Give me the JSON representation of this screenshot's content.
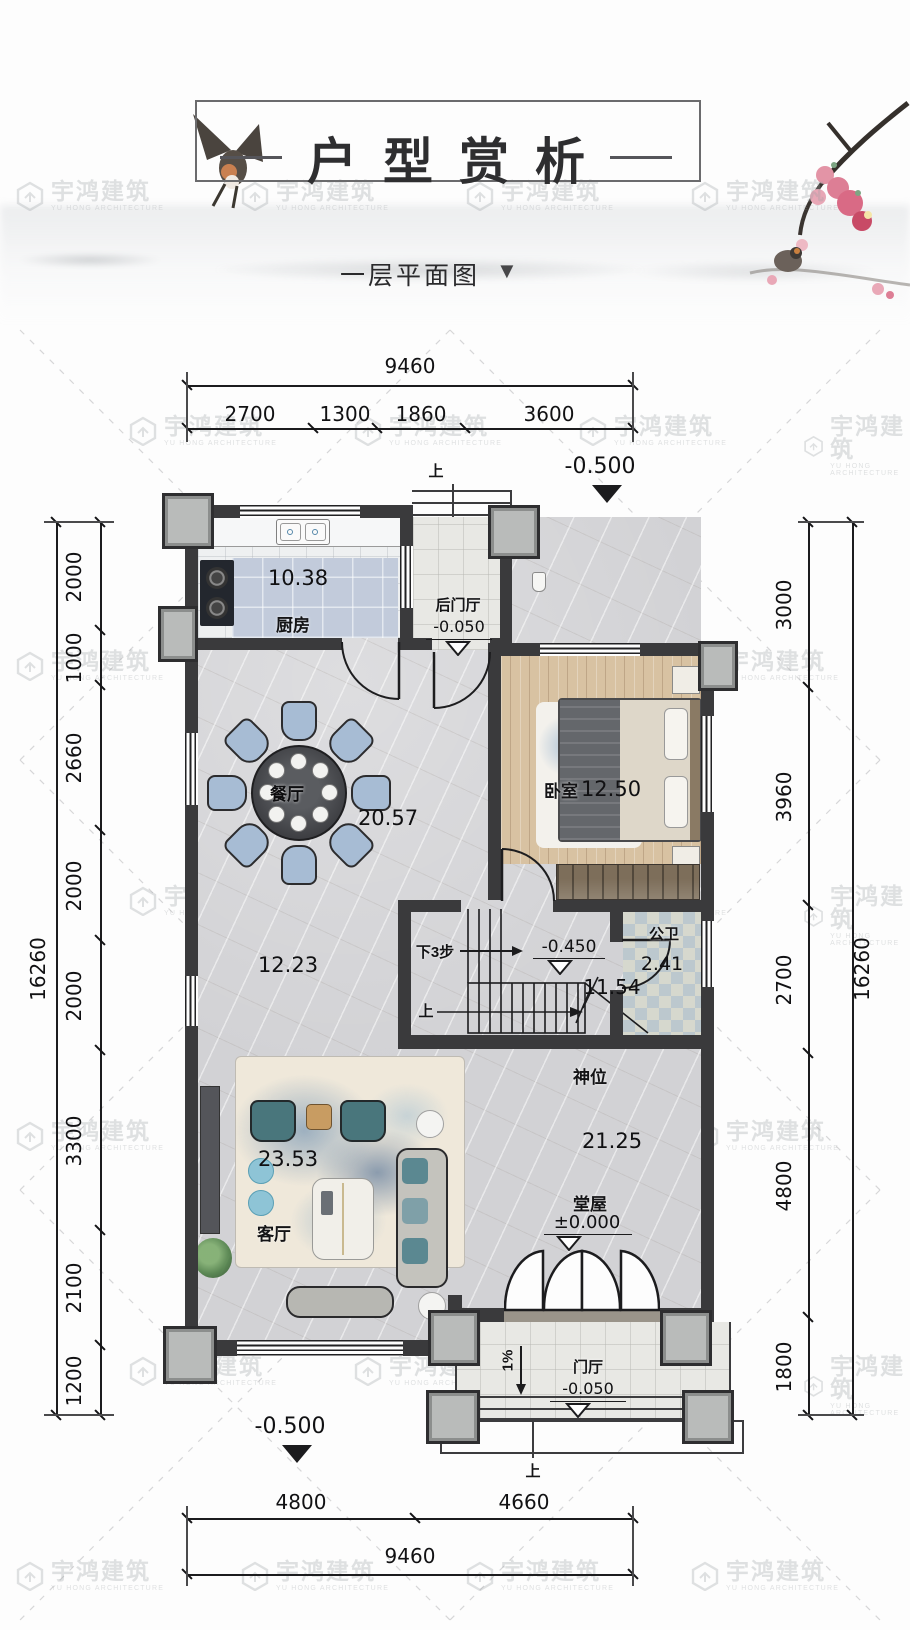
{
  "header": {
    "title": "户型赏析",
    "subtitle": "一层平面图",
    "subtitle_marker": "▼"
  },
  "watermark": {
    "cn": "宇鸿建筑",
    "en": "YU HONG ARCHITECTURE"
  },
  "site": {
    "north_level": "-0.500",
    "south_level": "-0.500"
  },
  "dims": {
    "top": {
      "total": "9460",
      "segments": [
        "2700",
        "1300",
        "1860",
        "3600"
      ]
    },
    "bottom": {
      "total": "9460",
      "segments": [
        "4800",
        "4660"
      ]
    },
    "left": {
      "total": "16260",
      "segments": [
        "2000",
        "1000",
        "2660",
        "2000",
        "2000",
        "3300",
        "2100",
        "1200"
      ]
    },
    "right": {
      "total": "16260",
      "segments": [
        "3000",
        "3960",
        "2700",
        "4800",
        "1800"
      ]
    }
  },
  "rooms": {
    "kitchen": {
      "name": "厨房",
      "area": "10.38"
    },
    "back_foyer": {
      "name": "后门厅",
      "level": "-0.050"
    },
    "dining": {
      "name": "餐厅",
      "area": "20.57"
    },
    "bedroom": {
      "name": "卧室",
      "area": "12.50"
    },
    "bath": {
      "name": "公卫",
      "area": "2.41"
    },
    "stairwell": {
      "area": "11.54",
      "down_note": "下3步",
      "mid_level": "-0.450",
      "up_note": "上"
    },
    "hallway": {
      "area": "12.23"
    },
    "living": {
      "name": "客厅",
      "area": "23.53"
    },
    "main_hall": {
      "name": "堂屋",
      "area": "21.25",
      "level": "±0.000"
    },
    "shrine": {
      "name": "神位"
    },
    "foyer": {
      "name": "门厅",
      "level": "-0.050",
      "slope": "1%"
    }
  },
  "annotations": {
    "entry_top": "上",
    "entry_bottom": "上"
  },
  "colors": {
    "wall": "#3a3a3c",
    "dim_line": "#1c1c1e",
    "marble": "#d2d2d5",
    "wood": "#d8c2a2",
    "kitchen_tile": "#c2cbdb",
    "plum_pink": "#d96a85"
  }
}
